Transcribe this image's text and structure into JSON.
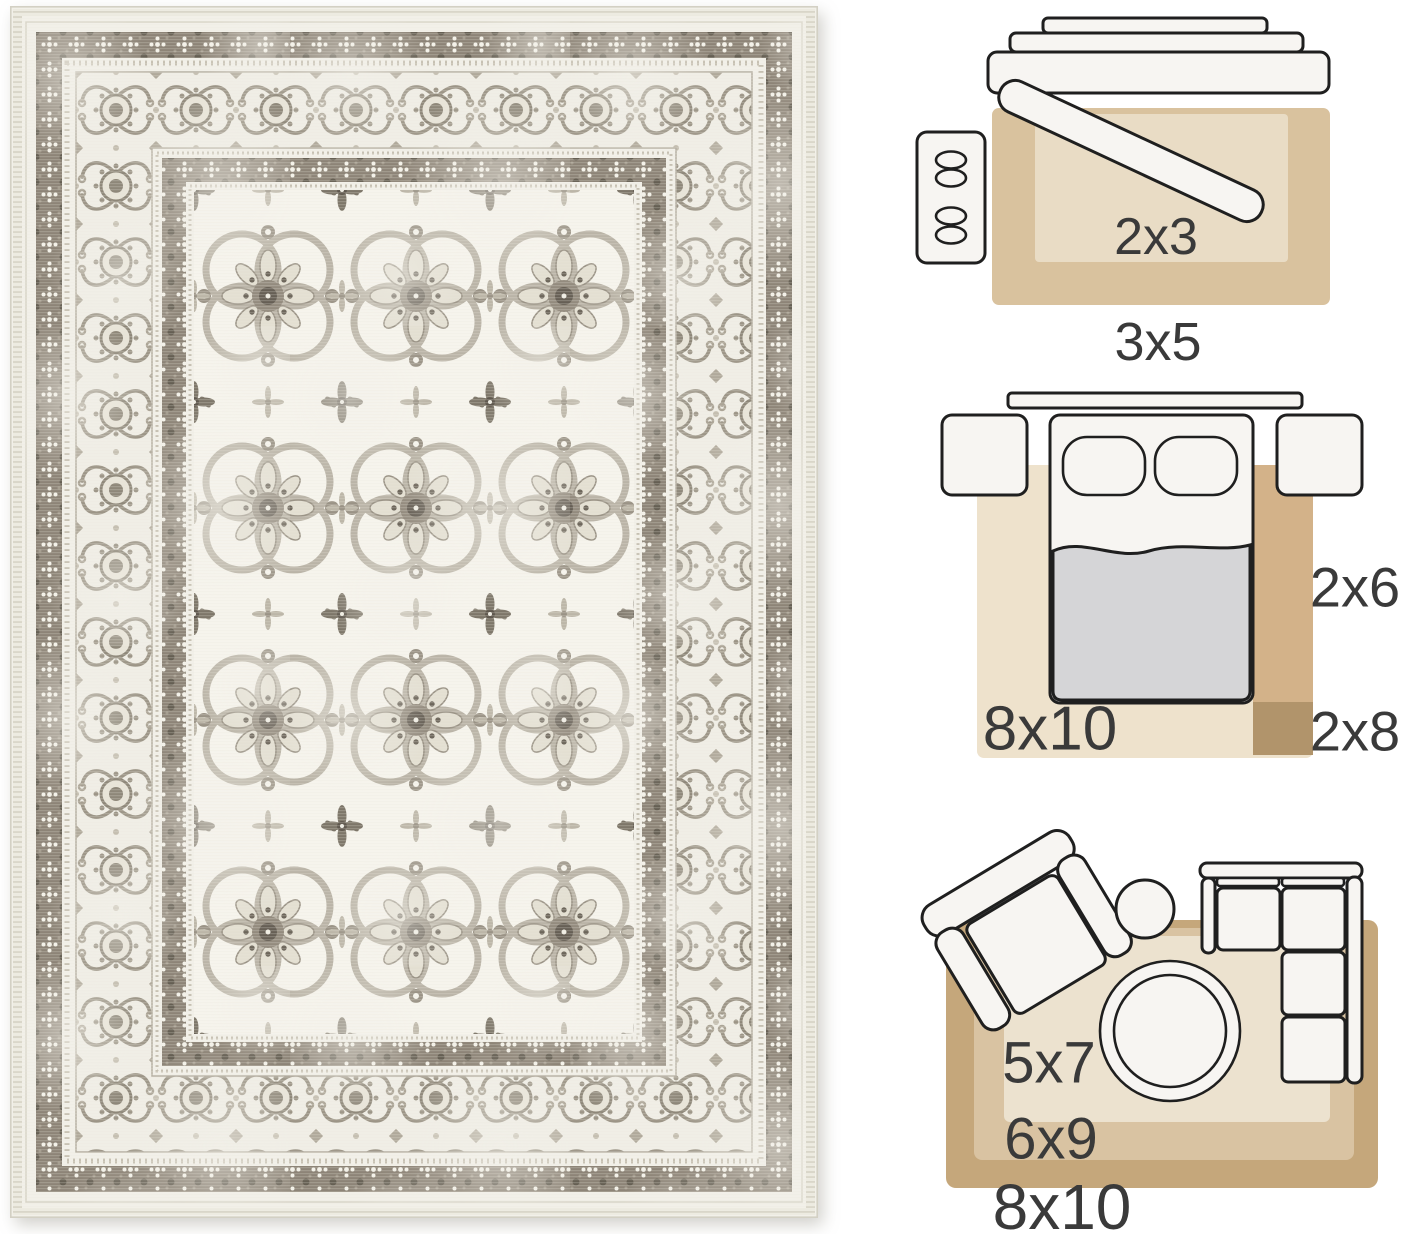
{
  "image_description": "Product image: distressed ivory and grey vintage oriental medallion rug beside three rug-size comparison floor-plan diagrams",
  "rug_photo": {
    "style_alt": "vintage floral medallion rug, ivory field with grey-taupe pattern",
    "palette": {
      "ivory_base": "#f2f0e9",
      "field_ivory": "#f6f4ed",
      "motif_grey": "#9a9386",
      "dark_band": "#8d8477",
      "dark_accent": "#665f55"
    }
  },
  "diagrams": {
    "entryway": {
      "inner_rug_label": "2x3",
      "outer_rug_label": "3x5"
    },
    "bedroom": {
      "area_rug_label": "8x10",
      "runner_label": "2x6",
      "runner_extension_label": "2x8"
    },
    "living_room": {
      "inner_rug_label": "5x7",
      "middle_rug_label": "6x9",
      "outer_rug_label": "8x10"
    }
  },
  "diagram_colors": {
    "entry_outer_tan": "#d9c29e",
    "entry_inner_beige": "#e9dcc5",
    "bedroom_rug_beige": "#eee2cc",
    "runner_tan": "#d3b289",
    "runner_dark_tan": "#b1946b",
    "living_outer_tan": "#c5a77b",
    "living_middle_tan": "#d9c3a2",
    "living_inner_beige": "#ece2cf",
    "furniture_fill": "#f7f5f2",
    "outline": "#1f1f1f",
    "blanket_grey": "#d5d5d7",
    "label_color": "#3a3a3a"
  }
}
